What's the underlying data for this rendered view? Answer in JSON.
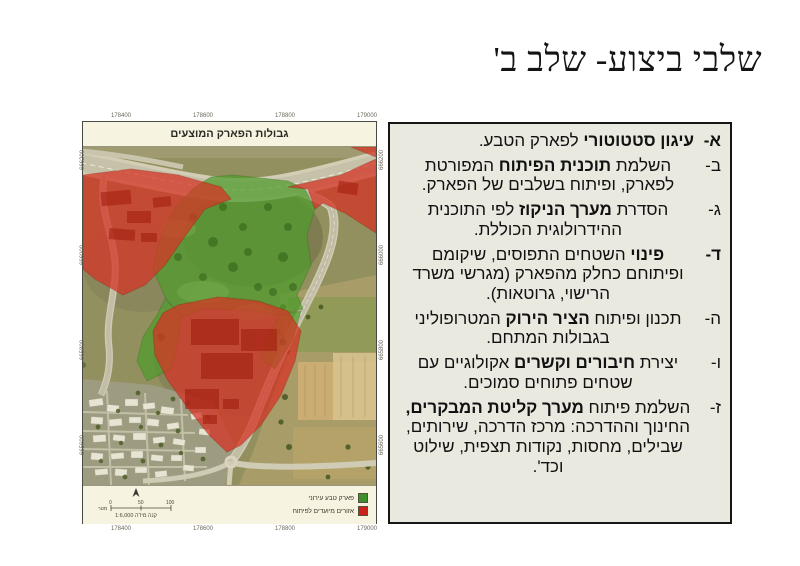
{
  "slide": {
    "title": "שלבי ביצוע- שלב ב'"
  },
  "map": {
    "title": "גבולות הפארק המוצעים",
    "legend": {
      "items": [
        {
          "label": "פארק טבע עירוני",
          "color": "#3f8f2f"
        },
        {
          "label": "אזורים מיועדים לפיתוח",
          "color": "#cc2218"
        }
      ],
      "scale_ticks": [
        "0",
        "50",
        "100"
      ],
      "scale_unit": "מטר",
      "scale_text": "קנה מידה 1:6,000"
    },
    "grid_labels": {
      "top": [
        "178400",
        "178600",
        "178800",
        "179000"
      ],
      "bottom": [
        "178400",
        "178600",
        "178800",
        "179000"
      ],
      "left": [
        "666200",
        "666000",
        "665800",
        "665600"
      ],
      "right": [
        "666200",
        "666000",
        "665800",
        "665600"
      ]
    },
    "overlay_colors": {
      "park_green": "#4f9c2c",
      "develop_red": "#d63425"
    }
  },
  "stages": {
    "items": [
      {
        "letter": "א-",
        "letter_bold": true,
        "segments": [
          {
            "text": "עיגון סטטוטורי",
            "bold": true
          },
          {
            "text": " לפארק הטבע.",
            "bold": false
          }
        ]
      },
      {
        "letter": "ב-",
        "letter_bold": false,
        "segments": [
          {
            "text": "השלמת ",
            "bold": false
          },
          {
            "text": "תוכנית הפיתוח",
            "bold": true
          },
          {
            "text": " המפורטת לפארק, ופיתוח בשלבים של הפארק.",
            "bold": false
          }
        ]
      },
      {
        "letter": "ג-",
        "letter_bold": false,
        "segments": [
          {
            "text": "הסדרת ",
            "bold": false
          },
          {
            "text": "מערך הניקוז",
            "bold": true
          },
          {
            "text": " לפי התוכנית ההידרולוגית הכוללת.",
            "bold": false
          }
        ]
      },
      {
        "letter": "ד-",
        "letter_bold": true,
        "segments": [
          {
            "text": "פינוי",
            "bold": true
          },
          {
            "text": " השטחים התפוסים, שיקומם ופיתוחם כחלק מהפארק (מגרשי משרד הרישוי, גרוטאות).",
            "bold": false
          }
        ]
      },
      {
        "letter": "ה-",
        "letter_bold": false,
        "segments": [
          {
            "text": "תכנון ופיתוח ",
            "bold": false
          },
          {
            "text": "הציר הירוק",
            "bold": true
          },
          {
            "text": " המטרופוליני בגבולות המתחם.",
            "bold": false
          }
        ]
      },
      {
        "letter": "ו-",
        "letter_bold": false,
        "segments": [
          {
            "text": "יצירת ",
            "bold": false
          },
          {
            "text": "חיבורים וקשרים",
            "bold": true
          },
          {
            "text": " אקולוגיים עם שטחים פתוחים סמוכים.",
            "bold": false
          }
        ]
      },
      {
        "letter": "ז-",
        "letter_bold": false,
        "segments": [
          {
            "text": "השלמת פיתוח ",
            "bold": false
          },
          {
            "text": "מערך קליטת המבקרים,",
            "bold": true
          },
          {
            "text": " החינוך וההדרכה: מרכז הדרכה, שירותים, שבילים, מחסות, נקודות תצפית, שילוט וכד'.",
            "bold": false
          }
        ]
      }
    ]
  }
}
